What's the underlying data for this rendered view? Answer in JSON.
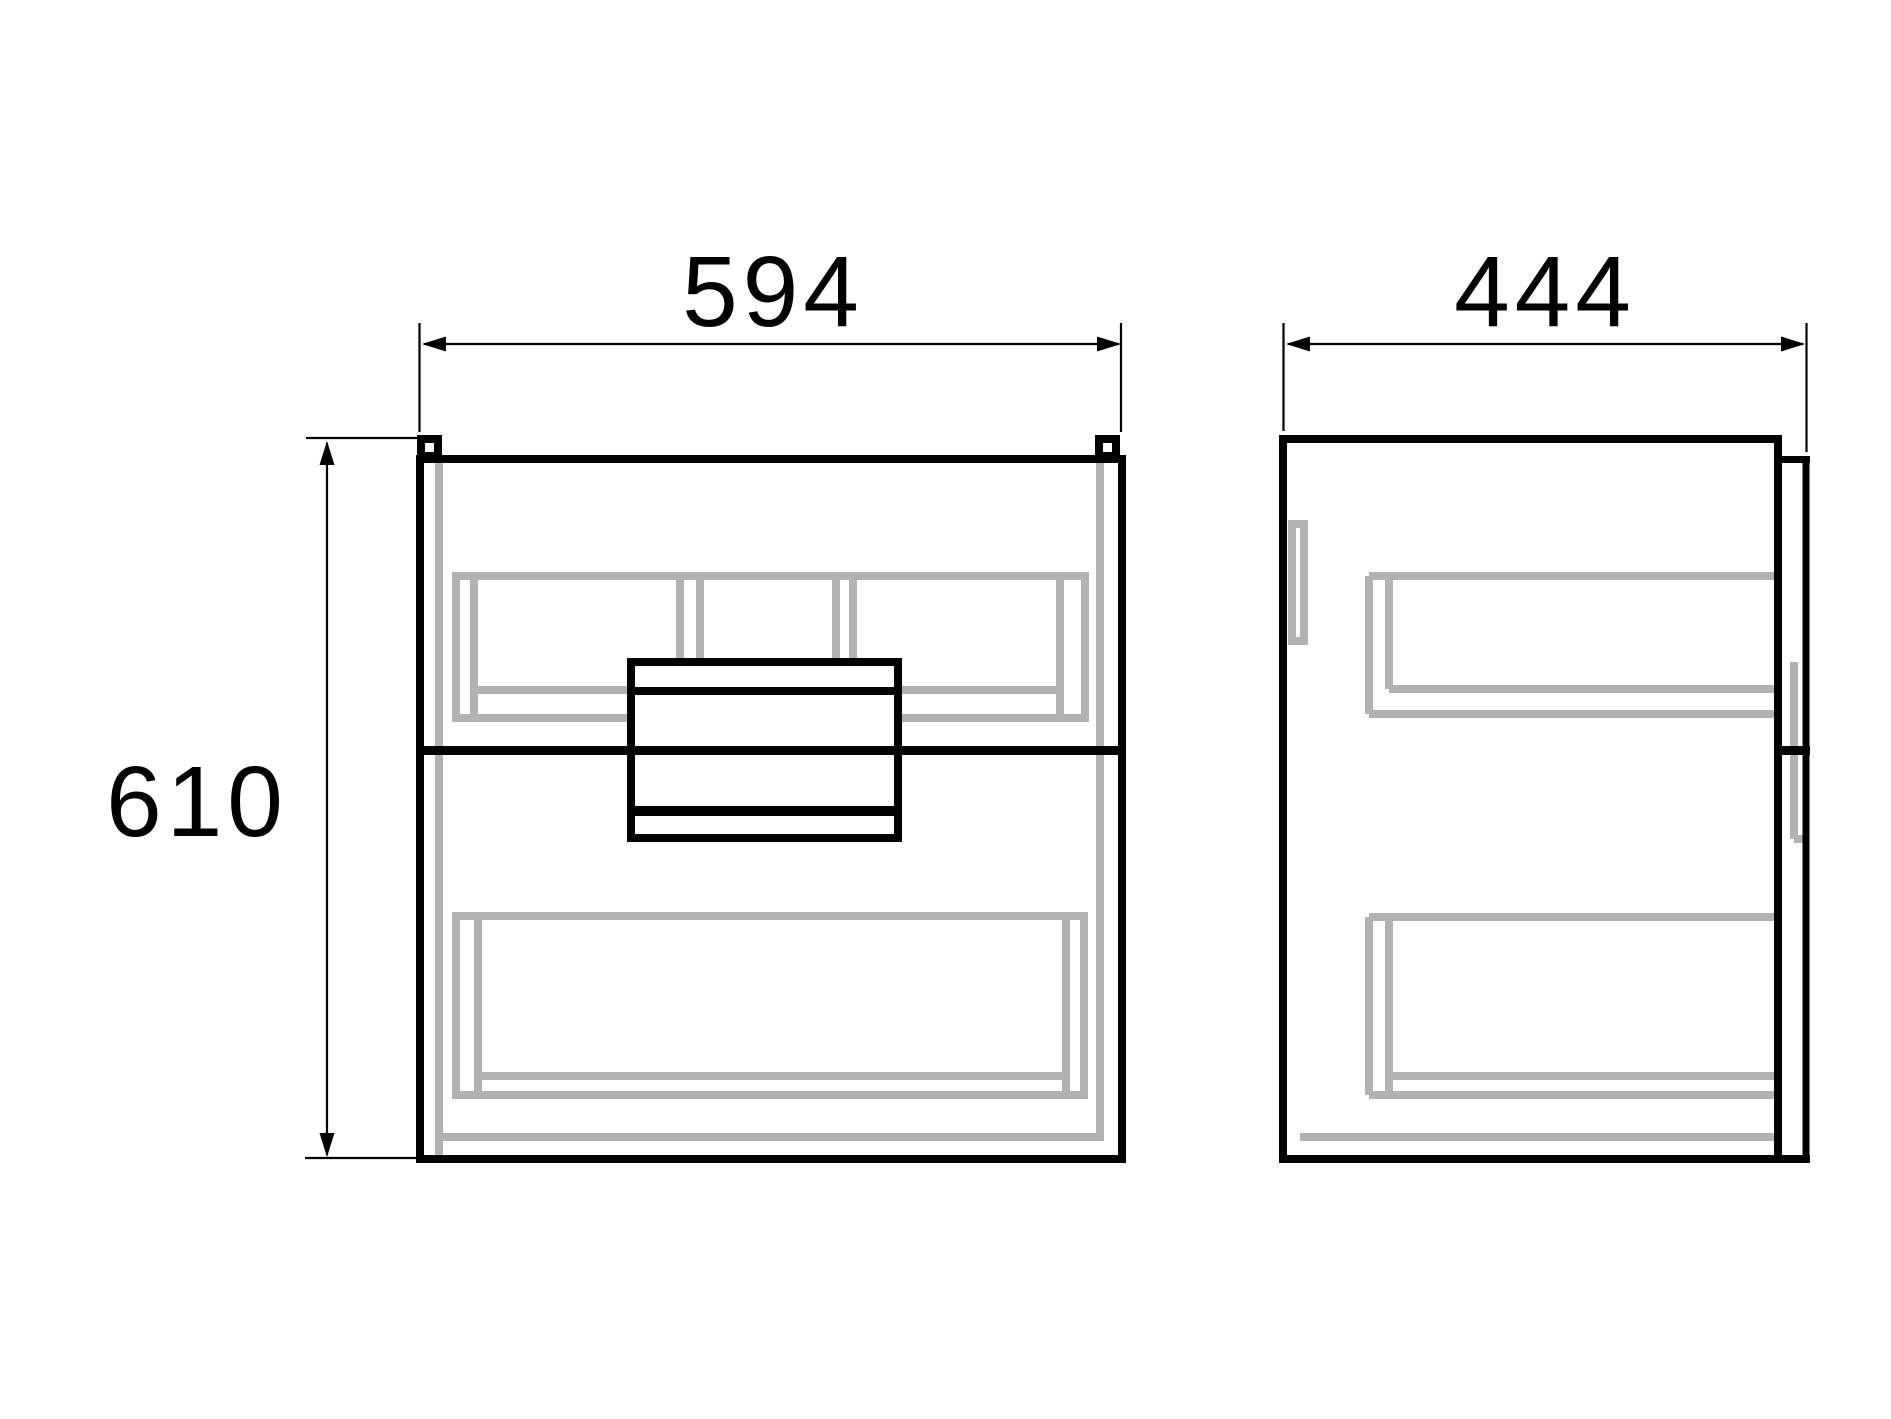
{
  "drawing": {
    "kind": "cabinet dimensional drawing, front and side orthographic views"
  },
  "dimensions": {
    "width": {
      "value": "594"
    },
    "depth": {
      "value": "444"
    },
    "height": {
      "value": "610"
    }
  },
  "colors": {
    "line": "#000000",
    "hidden_line": "#b2b2b2",
    "background": "#ffffff"
  }
}
